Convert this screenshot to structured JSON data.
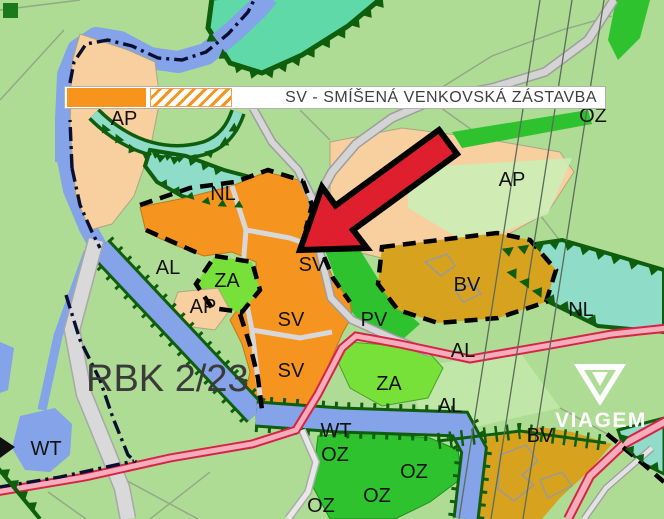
{
  "legend": {
    "text": "SV - SMÍŠENÁ VENKOVSKÁ ZÁSTAVBA",
    "code": "SV"
  },
  "map": {
    "area_label": {
      "text": "RBK 2/23"
    },
    "watermark": {
      "text": "VIAGEM"
    },
    "zone_labels": [
      {
        "text": "AP",
        "x": 124,
        "y": 125
      },
      {
        "text": "NL",
        "x": 223,
        "y": 200
      },
      {
        "text": "AL",
        "x": 168,
        "y": 274
      },
      {
        "text": "ZA",
        "x": 227,
        "y": 287
      },
      {
        "text": "AP",
        "x": 203,
        "y": 313
      },
      {
        "text": "SV",
        "x": 312,
        "y": 271,
        "s": 22
      },
      {
        "text": "SV",
        "x": 291,
        "y": 326,
        "s": 22
      },
      {
        "text": "PV",
        "x": 374,
        "y": 326,
        "s": 21
      },
      {
        "text": "SV",
        "x": 291,
        "y": 377,
        "s": 22
      },
      {
        "text": "AP",
        "x": 391,
        "y": 203
      },
      {
        "text": "AP",
        "x": 512,
        "y": 186
      },
      {
        "text": "OZ",
        "x": 593,
        "y": 122
      },
      {
        "text": "BV",
        "x": 467,
        "y": 291,
        "s": 21
      },
      {
        "text": "NL",
        "x": 581,
        "y": 316
      },
      {
        "text": "AL",
        "x": 463,
        "y": 357,
        "s": 19
      },
      {
        "text": "ZA",
        "x": 389,
        "y": 390
      },
      {
        "text": "AL",
        "x": 450,
        "y": 412,
        "s": 19
      },
      {
        "text": "WT",
        "x": 46,
        "y": 455
      },
      {
        "text": "WT",
        "x": 336,
        "y": 437
      },
      {
        "text": "OZ",
        "x": 335,
        "y": 461
      },
      {
        "text": "OZ",
        "x": 414,
        "y": 478
      },
      {
        "text": "OZ",
        "x": 377,
        "y": 502
      },
      {
        "text": "OZ",
        "x": 321,
        "y": 512
      },
      {
        "text": "BV",
        "x": 540,
        "y": 442,
        "s": 18
      }
    ]
  },
  "colors": {
    "legend_orange": "#F7941D",
    "sv_orange": "#F5941F",
    "ap_peach": "#F8CF9F",
    "za_green": "#77E13A",
    "oz_green": "#2EC32E",
    "bv_ochre": "#D7A31E",
    "nl_teal": "#8FDCC8",
    "top_teal": "#5FD9A7",
    "water_blue": "#84A3E8",
    "background_green": "#AEDC94",
    "border_dark_green": "#0E5E0E",
    "road_red": "#D92346",
    "road_pink": "#F4ADBA",
    "arrow_red": "#E01F2E"
  }
}
